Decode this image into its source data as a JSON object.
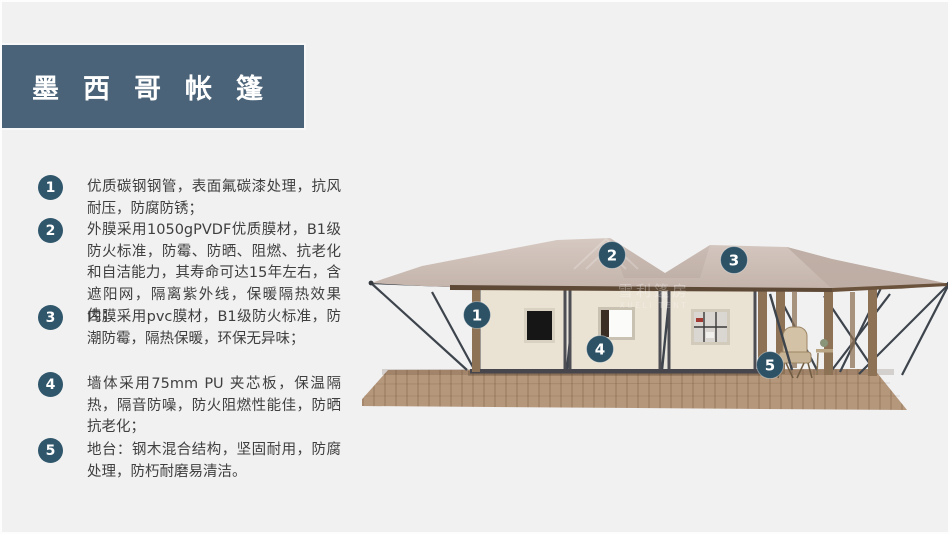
{
  "slide": {
    "background": "#f1f1f2",
    "border_color": "#fdfdfd"
  },
  "title": {
    "text": "墨西哥帐篷",
    "bg_color": "#4a6378",
    "text_color": "#ffffff"
  },
  "badge_color": "#30566b",
  "features": [
    {
      "num": "1",
      "text": "优质碳钢钢管，表面氟碳漆处理，抗风耐压，防腐防锈；"
    },
    {
      "num": "2",
      "text": "外膜采用1050gPVDF优质膜材，B1级防火标准，防霉、防晒、阻燃、抗老化和自洁能力，其寿命可达15年左右，含遮阳网，隔离紫外线，保暖隔热效果佳；"
    },
    {
      "num": "3",
      "text": "内膜采用pvc膜材，B1级防火标准，防潮防霉，隔热保暖，环保无异味；"
    },
    {
      "num": "4",
      "text": "墙体采用75mm PU 夹芯板，保温隔热，隔音防噪，防火阻燃性能佳，防晒抗老化；"
    },
    {
      "num": "5",
      "text": "地台：钢木混合结构，坚固耐用，防腐处理，防朽耐磨易清洁。"
    }
  ],
  "illustration": {
    "watermark": {
      "cn": "雪利篷房",
      "en": "XUELI TENT"
    },
    "callouts": [
      {
        "num": "1"
      },
      {
        "num": "2"
      },
      {
        "num": "3"
      },
      {
        "num": "4"
      },
      {
        "num": "5"
      }
    ],
    "colors": {
      "roof": "#c9bab1",
      "roof_dark": "#bcaba2",
      "fascia": "#5e4936",
      "wall": "#eae2d3",
      "frame": "#4d4d54",
      "steel": "#3d444c",
      "wood": "#8d7256",
      "deck": "#b5977b",
      "deck_line": "#9b7e61",
      "callout_bg": "#2d5266",
      "window_dark": "#161616",
      "window_light": "#fbfbf9"
    }
  }
}
